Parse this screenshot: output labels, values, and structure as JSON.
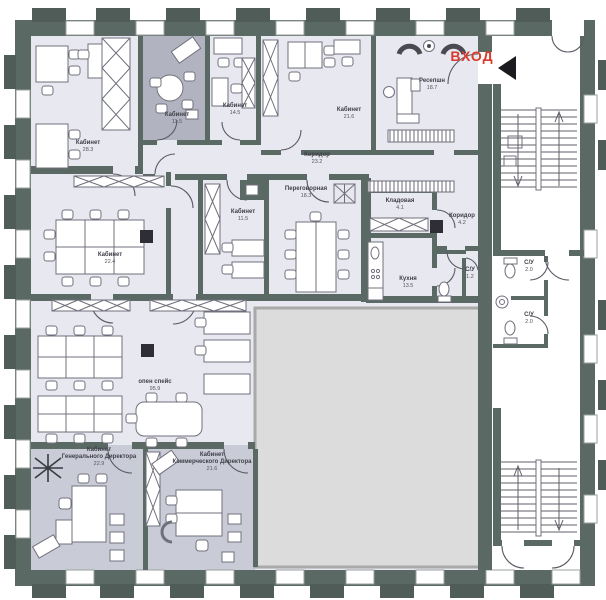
{
  "plan": {
    "entrance": {
      "label": "ВХОД",
      "color": "#d93a2b"
    },
    "colors": {
      "wall": "#5a6963",
      "room_fill": "#e8e8f0",
      "dark_room_fill": "#b1b3c0",
      "director_room_fill": "#c9cbd6",
      "masked_area_fill": "#dcdcdc",
      "entrance_red": "#d93a2b"
    },
    "rooms": [
      {
        "name": "Кабинет",
        "area": "28.3"
      },
      {
        "name": "Кабинет",
        "area": "11.5"
      },
      {
        "name": "Кабинет",
        "area": "14.5"
      },
      {
        "name": "Кабинет",
        "area": "21.6"
      },
      {
        "name": "Ресепшн",
        "area": "18.7"
      },
      {
        "name": "Коридор",
        "area": "23.2"
      },
      {
        "name": "Кабинет",
        "area": "22.4"
      },
      {
        "name": "Кабинет",
        "area": "11.5"
      },
      {
        "name": "Переговорная",
        "area": "18.3"
      },
      {
        "name": "Кладовая",
        "area": "4.1"
      },
      {
        "name": "Коридор",
        "area": "4.2"
      },
      {
        "name": "Кухня",
        "area": "13.5"
      },
      {
        "name": "С/У",
        "area": "1.2"
      },
      {
        "name": "С/У",
        "area": "2.0"
      },
      {
        "name": "С/У",
        "area": "2.0"
      },
      {
        "name": "опен спейс",
        "area": "95.9"
      },
      {
        "name": "Кабинет",
        "line2": "Генерального Директора",
        "area": "22.9"
      },
      {
        "name": "Кабинет",
        "line2": "Коммерческого Директора",
        "area": "21.6"
      }
    ]
  }
}
